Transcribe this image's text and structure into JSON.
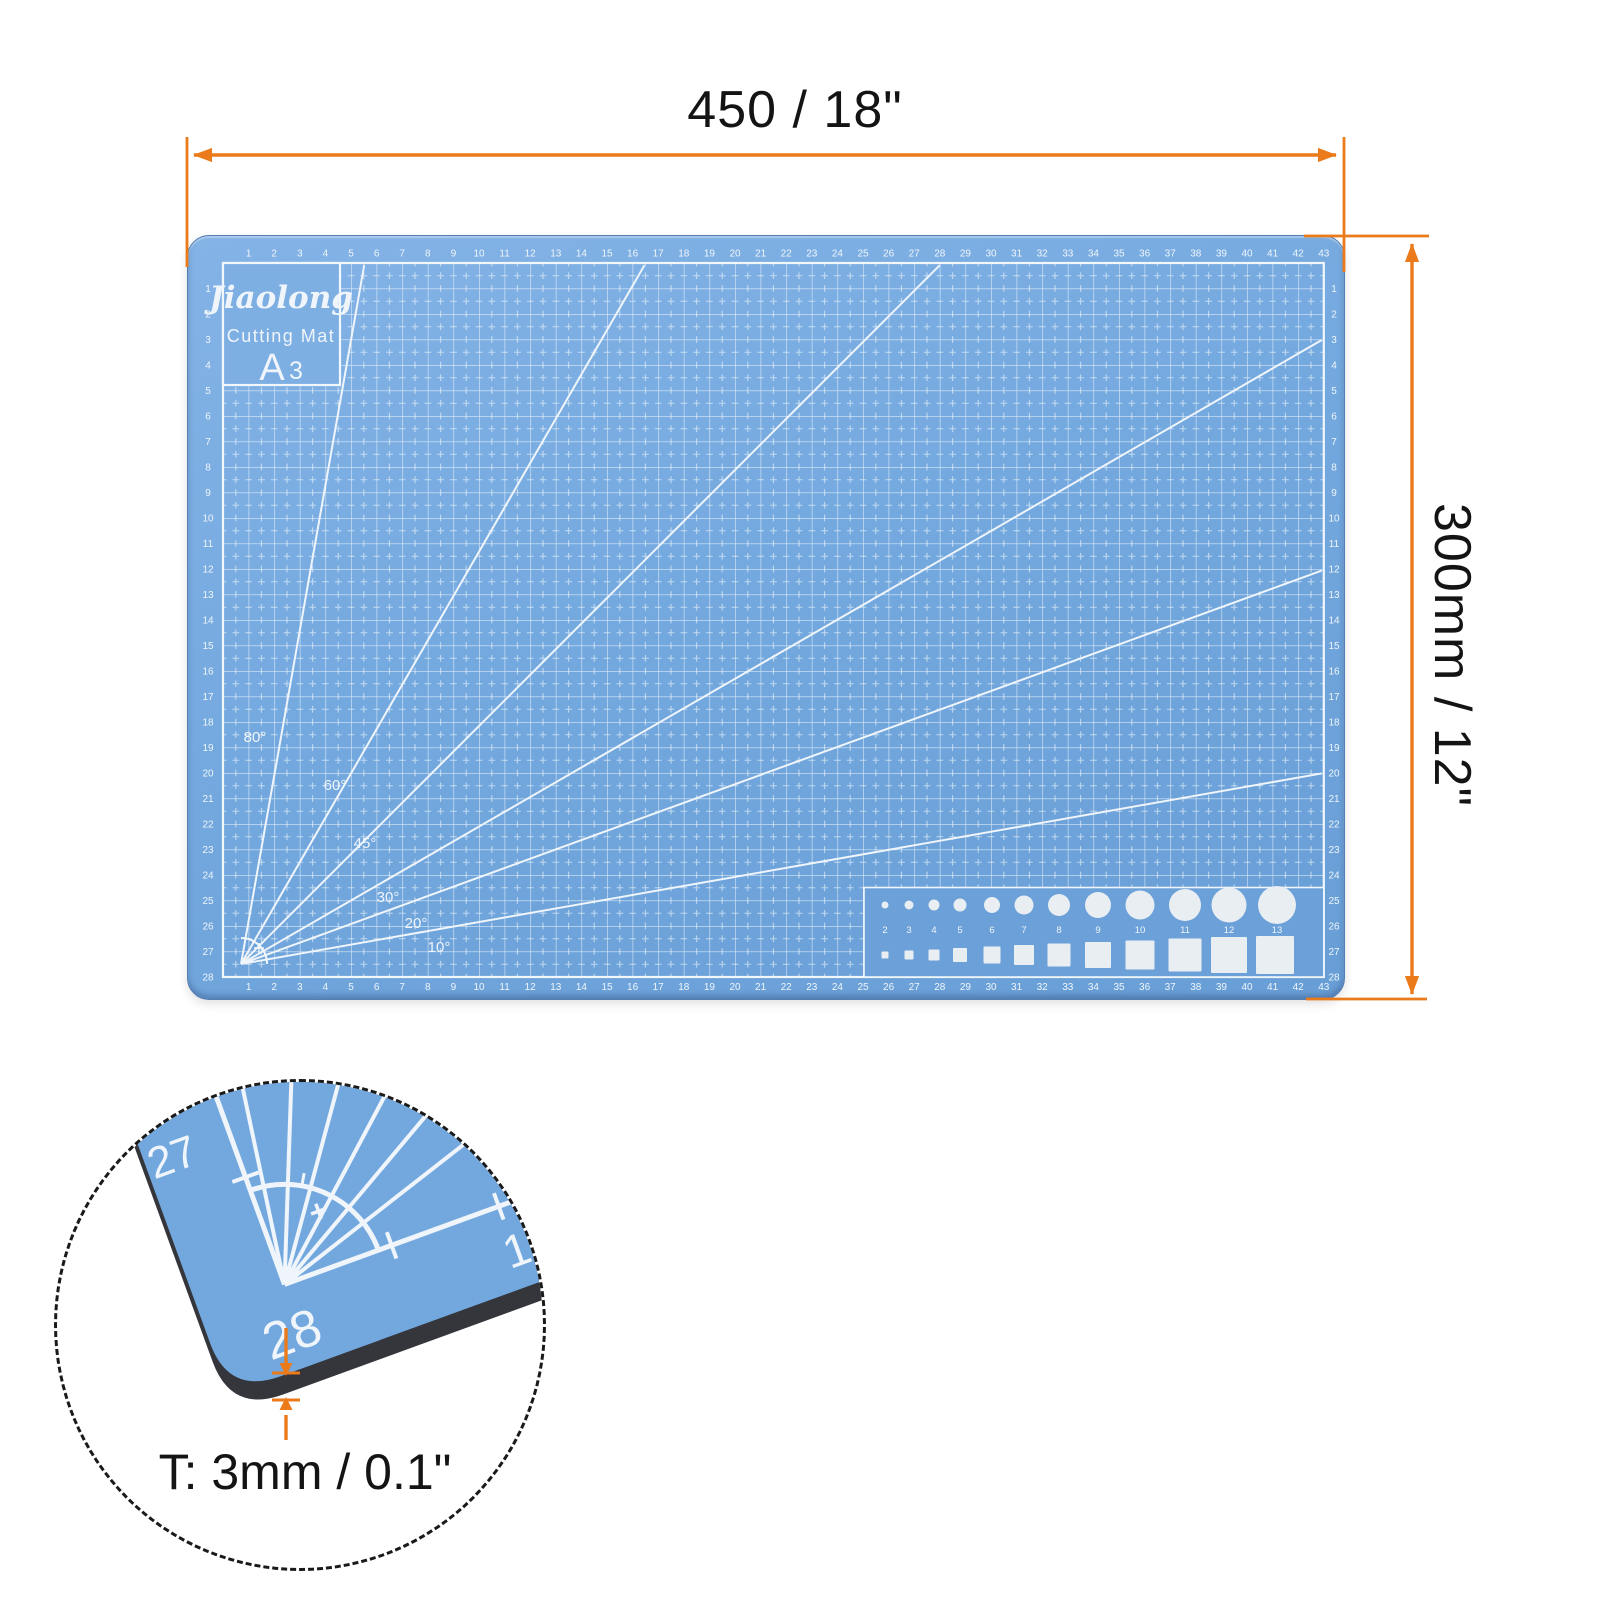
{
  "annotations": {
    "width_label": "450 / 18\"",
    "height_label": "300mm / 12\"",
    "thickness_label": "T: 3mm / 0.1\""
  },
  "mat": {
    "brand": "Jiaolong",
    "product_name": "Cutting Mat",
    "size_letter": "A",
    "size_digit": "3",
    "h_ruler_start": 1,
    "h_ruler_end": 43,
    "v_ruler_start": 1,
    "v_ruler_end": 28,
    "angle_lines": [
      {
        "label": "80°",
        "angle": 80
      },
      {
        "label": "60°",
        "angle": 60
      },
      {
        "label": "45°",
        "angle": 45
      },
      {
        "label": "30°",
        "angle": 30
      },
      {
        "label": "20°",
        "angle": 20
      },
      {
        "label": "10°",
        "angle": 10
      }
    ],
    "template_numbers": [
      "2",
      "3",
      "4",
      "5",
      "6",
      "7",
      "8",
      "9",
      "10",
      "11",
      "12",
      "13"
    ]
  },
  "detail": {
    "corner_numbers": [
      "26",
      "27",
      "28",
      "1"
    ]
  },
  "colors": {
    "mat_blue": "#74A9DF",
    "marking_white": "#EFF5FA",
    "dimension_orange": "#EA7A1A",
    "text_black": "#141414",
    "mat_edge_dark": "#34363B",
    "template_shape_fill": "#E9EEF3"
  }
}
